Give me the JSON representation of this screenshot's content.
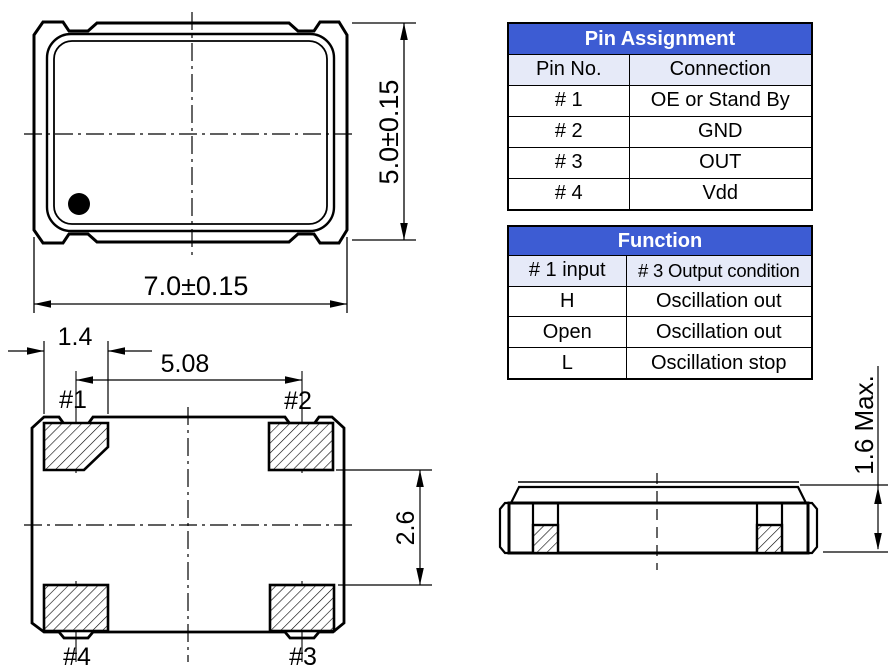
{
  "colors": {
    "header_blue": "#3D5CD3",
    "subheader_blue": "#E6EAF8",
    "line_black": "#000000"
  },
  "tables": {
    "pin_assignment": {
      "title": "Pin Assignment",
      "columns": {
        "pin": "Pin No.",
        "connection": "Connection"
      },
      "rows": [
        {
          "pin": "# 1",
          "connection": "OE or Stand By"
        },
        {
          "pin": "# 2",
          "connection": "GND"
        },
        {
          "pin": "# 3",
          "connection": "OUT"
        },
        {
          "pin": "# 4",
          "connection": "Vdd"
        }
      ]
    },
    "function": {
      "title": "Function",
      "columns": {
        "input": "# 1 input",
        "output": "# 3 Output condition"
      },
      "rows": [
        {
          "input": "H",
          "output": "Oscillation out"
        },
        {
          "input": "Open",
          "output": "Oscillation out"
        },
        {
          "input": "L",
          "output": "Oscillation stop"
        }
      ]
    }
  },
  "drawings": {
    "top_view": {
      "width_dim": "7.0±0.15",
      "height_dim": "5.0±0.15"
    },
    "bottom_view": {
      "pad_width_dim": "1.4",
      "pad_pitch_dim": "5.08",
      "pad_row_dim": "2.6",
      "pad1_label": "#1",
      "pad2_label": "#2",
      "pad3_label": "#3",
      "pad4_label": "#4"
    },
    "side_view": {
      "height_dim": "1.6 Max."
    }
  }
}
